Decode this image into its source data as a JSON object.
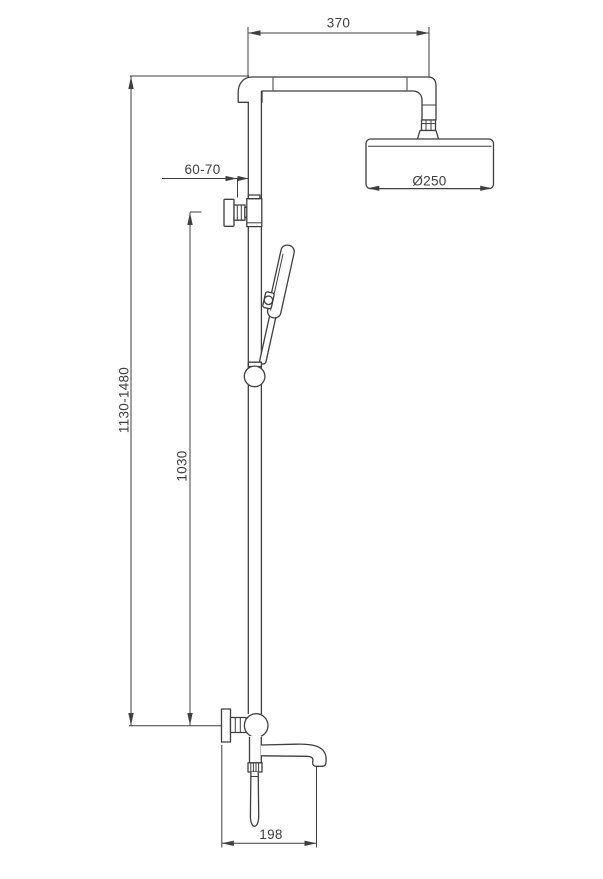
{
  "drawing": {
    "dimensions": {
      "arm_length": "370",
      "wall_distance": "60-70",
      "head_diameter": "Ø250",
      "overall_height": "1130-1480",
      "slide_bar_height": "1030",
      "spout_reach": "198"
    },
    "colors": {
      "line": "#3f3f3f",
      "background": "#ffffff"
    }
  }
}
